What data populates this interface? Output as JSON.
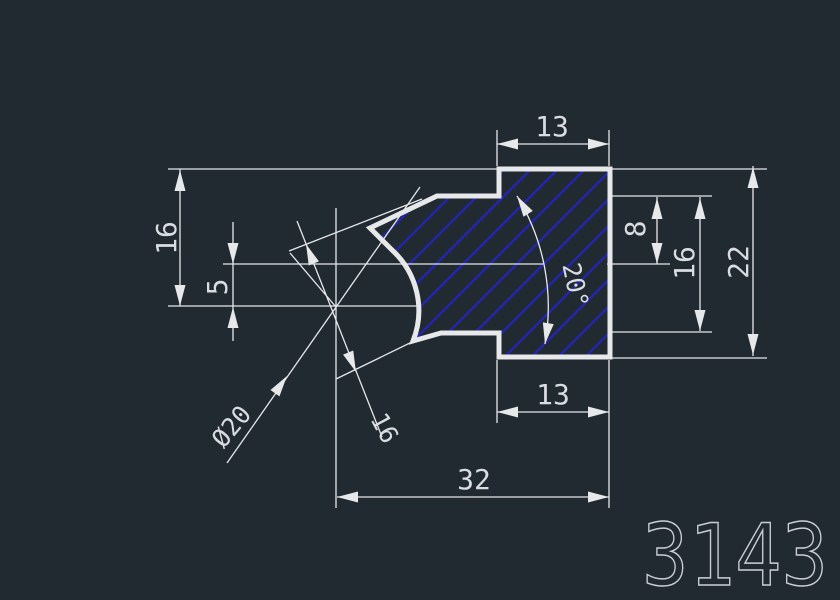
{
  "part_number": "3143",
  "dimensions": {
    "top_width": "13",
    "step_height_right": "8",
    "inner_height_right": "16",
    "total_height": "22",
    "height_left": "16",
    "offset_left": "5",
    "bottom_width": "13",
    "total_width": "32",
    "diameter": "Ø20",
    "diagonal_length": "16",
    "angle": "20°"
  },
  "colors": {
    "background": "#212931",
    "lines": "#e6e8ea",
    "hatch": "#2325b5",
    "text": "#d9dce0"
  }
}
